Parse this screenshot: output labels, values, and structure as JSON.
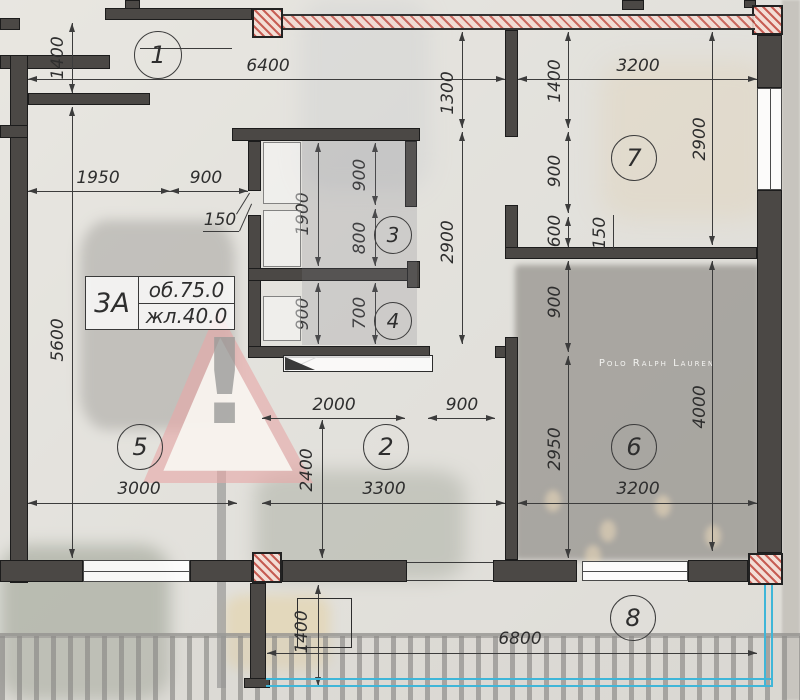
{
  "area_label": {
    "unit": "3А",
    "row1": "об.75.0",
    "row2": "жл.40.0"
  },
  "photo": {
    "storefront_sign": "Polo Ralph Lauren",
    "sign_mark": "!"
  },
  "colors": {
    "wall": "#4b4845",
    "dim": "#3c3c3c",
    "red_hatch": "#c2564c",
    "cyan_rail": "#3fb6d8"
  },
  "plan": {
    "rooms": [
      {
        "n": "1",
        "x": 158,
        "y": 55,
        "r": 24
      },
      {
        "n": "7",
        "x": 634,
        "y": 158,
        "r": 23
      },
      {
        "n": "3",
        "x": 393,
        "y": 235,
        "r": 19
      },
      {
        "n": "4",
        "x": 393,
        "y": 321,
        "r": 19
      },
      {
        "n": "5",
        "x": 140,
        "y": 447,
        "r": 23
      },
      {
        "n": "2",
        "x": 386,
        "y": 447,
        "r": 23
      },
      {
        "n": "6",
        "x": 634,
        "y": 447,
        "r": 23
      },
      {
        "n": "8",
        "x": 633,
        "y": 618,
        "r": 23
      }
    ],
    "dims": [
      {
        "t": "6400",
        "o": "h",
        "a": 28,
        "b": 505,
        "p": 79,
        "lx": 268,
        "ly": 66
      },
      {
        "t": "3200",
        "o": "h",
        "a": 518,
        "b": 757,
        "p": 79,
        "lx": 638,
        "ly": 66
      },
      {
        "t": "1950",
        "o": "h",
        "a": 28,
        "b": 170,
        "p": 191,
        "lx": 98,
        "ly": 178
      },
      {
        "t": "900",
        "o": "h",
        "a": 170,
        "b": 248,
        "p": 191,
        "lx": 206,
        "ly": 178
      },
      {
        "t": "2000",
        "o": "h",
        "a": 262,
        "b": 405,
        "p": 418,
        "lx": 334,
        "ly": 405
      },
      {
        "t": "900",
        "o": "h",
        "a": 428,
        "b": 495,
        "p": 418,
        "lx": 462,
        "ly": 405
      },
      {
        "t": "3000",
        "o": "h",
        "a": 28,
        "b": 237,
        "p": 503,
        "lx": 139,
        "ly": 489
      },
      {
        "t": "3300",
        "o": "h",
        "a": 262,
        "b": 505,
        "p": 503,
        "lx": 384,
        "ly": 489
      },
      {
        "t": "3200",
        "o": "h",
        "a": 518,
        "b": 757,
        "p": 503,
        "lx": 638,
        "ly": 489
      },
      {
        "t": "6800",
        "o": "h",
        "a": 267,
        "b": 757,
        "p": 653,
        "lx": 520,
        "ly": 639
      },
      {
        "t": "1400",
        "o": "v",
        "a": 23,
        "b": 93,
        "p": 72,
        "lx": 58,
        "ly": 58
      },
      {
        "t": "5600",
        "o": "v",
        "a": 107,
        "b": 558,
        "p": 72,
        "lx": 58,
        "ly": 340
      },
      {
        "t": "1300",
        "o": "v",
        "a": 32,
        "b": 128,
        "p": 462,
        "lx": 448,
        "ly": 93
      },
      {
        "t": "2900",
        "o": "v",
        "a": 132,
        "b": 344,
        "p": 462,
        "lx": 448,
        "ly": 242
      },
      {
        "t": "1400",
        "o": "v",
        "a": 32,
        "b": 128,
        "p": 568,
        "lx": 555,
        "ly": 81
      },
      {
        "t": "900",
        "o": "v",
        "a": 132,
        "b": 213,
        "p": 568,
        "lx": 555,
        "ly": 171
      },
      {
        "t": "600",
        "o": "v",
        "a": 217,
        "b": 247,
        "p": 568,
        "lx": 555,
        "ly": 231
      },
      {
        "t": "900",
        "o": "v",
        "a": 261,
        "b": 352,
        "p": 568,
        "lx": 555,
        "ly": 302
      },
      {
        "t": "2950",
        "o": "v",
        "a": 356,
        "b": 558,
        "p": 568,
        "lx": 555,
        "ly": 449
      },
      {
        "t": "2900",
        "o": "v",
        "a": 32,
        "b": 245,
        "p": 712,
        "lx": 700,
        "ly": 139
      },
      {
        "t": "4000",
        "o": "v",
        "a": 261,
        "b": 551,
        "p": 712,
        "lx": 700,
        "ly": 407
      },
      {
        "t": "1900",
        "o": "v",
        "a": 143,
        "b": 266,
        "p": 318,
        "lx": 303,
        "ly": 214
      },
      {
        "t": "900",
        "o": "v",
        "a": 143,
        "b": 205,
        "p": 375,
        "lx": 360,
        "ly": 175
      },
      {
        "t": "800",
        "o": "v",
        "a": 209,
        "b": 266,
        "p": 375,
        "lx": 360,
        "ly": 238
      },
      {
        "t": "900",
        "o": "v",
        "a": 283,
        "b": 344,
        "p": 318,
        "lx": 303,
        "ly": 314
      },
      {
        "t": "700",
        "o": "v",
        "a": 283,
        "b": 344,
        "p": 375,
        "lx": 360,
        "ly": 313
      },
      {
        "t": "2400",
        "o": "v",
        "a": 420,
        "b": 558,
        "p": 322,
        "lx": 307,
        "ly": 470
      },
      {
        "t": "1400",
        "o": "v",
        "a": 585,
        "b": 686,
        "p": 318,
        "lx": 302,
        "ly": 632
      }
    ],
    "leaders": [
      {
        "t": "150",
        "x": 220,
        "y": 220,
        "rot": false
      },
      {
        "t": "150",
        "x": 600,
        "y": 233,
        "rot": true
      }
    ],
    "walls": [
      [
        105,
        8,
        147,
        12
      ],
      [
        125,
        0,
        15,
        9
      ],
      [
        622,
        0,
        22,
        10
      ],
      [
        744,
        0,
        12,
        8
      ],
      [
        0,
        18,
        20,
        12
      ],
      [
        0,
        55,
        110,
        14
      ],
      [
        10,
        55,
        18,
        528
      ],
      [
        28,
        93,
        122,
        12
      ],
      [
        0,
        125,
        28,
        13
      ],
      [
        232,
        128,
        188,
        13
      ],
      [
        405,
        141,
        12,
        66
      ],
      [
        248,
        141,
        13,
        50
      ],
      [
        248,
        215,
        13,
        143
      ],
      [
        248,
        268,
        172,
        13
      ],
      [
        407,
        261,
        13,
        27
      ],
      [
        248,
        346,
        182,
        12
      ],
      [
        495,
        346,
        23,
        12
      ],
      [
        505,
        30,
        13,
        107
      ],
      [
        505,
        205,
        13,
        45
      ],
      [
        505,
        337,
        13,
        223
      ],
      [
        505,
        247,
        252,
        12
      ],
      [
        757,
        35,
        25,
        53
      ],
      [
        757,
        190,
        25,
        363
      ],
      [
        0,
        560,
        83,
        22
      ],
      [
        190,
        560,
        62,
        22
      ],
      [
        282,
        560,
        125,
        22
      ],
      [
        493,
        560,
        84,
        22
      ],
      [
        688,
        560,
        60,
        22
      ],
      [
        250,
        583,
        16,
        100
      ],
      [
        244,
        678,
        26,
        10
      ]
    ],
    "red_columns": [
      [
        252,
        8,
        31,
        30
      ],
      [
        752,
        5,
        31,
        30
      ],
      [
        252,
        552,
        30,
        31
      ],
      [
        748,
        553,
        35,
        32
      ]
    ],
    "red_band": [
      283,
      14,
      472,
      16
    ],
    "windows": [
      {
        "x": 83,
        "y": 560,
        "w": 107,
        "h": 22,
        "o": "h"
      },
      {
        "x": 582,
        "y": 561,
        "w": 106,
        "h": 20,
        "o": "h"
      },
      {
        "x": 757,
        "y": 88,
        "w": 25,
        "h": 102,
        "o": "v"
      }
    ],
    "lines": [
      [
        203,
        231,
        239,
        231
      ],
      [
        239,
        231,
        251,
        204
      ],
      [
        614,
        215,
        614,
        250
      ],
      [
        236,
        214,
        249,
        193
      ],
      [
        407,
        562,
        493,
        562
      ],
      [
        407,
        580,
        493,
        580
      ],
      [
        140,
        48,
        232,
        48
      ],
      [
        285,
        371,
        318,
        356
      ]
    ],
    "closets": [
      [
        263,
        142,
        38,
        62
      ],
      [
        263,
        210,
        38,
        57
      ],
      [
        263,
        296,
        38,
        45
      ]
    ],
    "shade": [
      302,
      141,
      115,
      204
    ],
    "counter": [
      283,
      355,
      150,
      17
    ],
    "balcony_rect": [
      297,
      598,
      55,
      50
    ],
    "rail_h": [
      266,
      678,
      506
    ],
    "rail_v": [
      764,
      585,
      102
    ]
  }
}
